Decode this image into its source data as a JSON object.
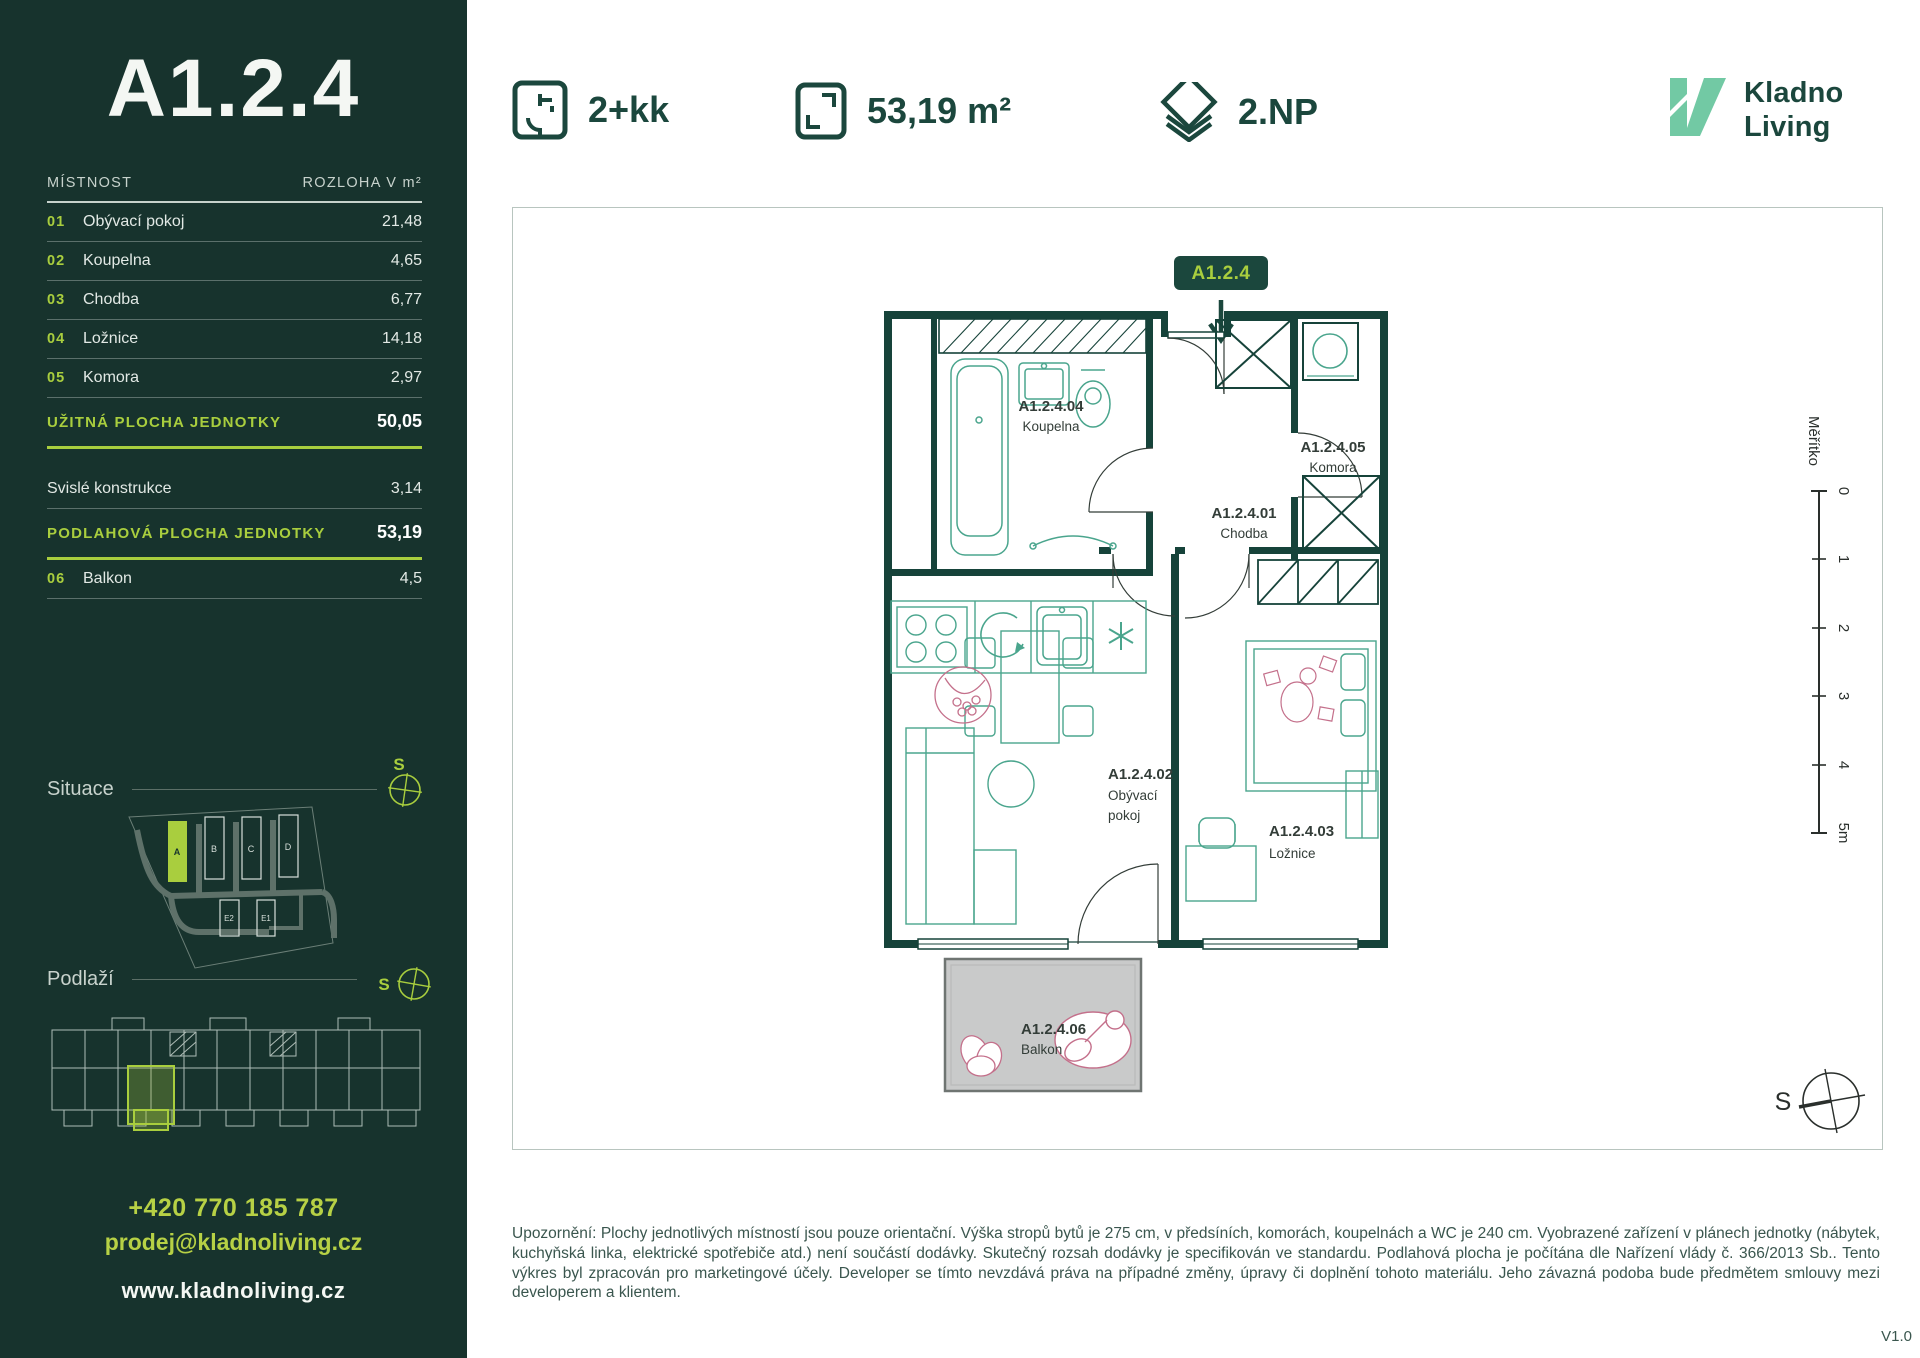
{
  "colors": {
    "sidebar_bg": "#17332D",
    "accent_lime": "#A9CE3E",
    "dark_teal": "#1B473D",
    "logo_mint": "#72C9A4",
    "furniture_teal": "#4AA58D",
    "decor_pink": "#C4708B",
    "balcony_gray": "#C9CACA"
  },
  "sidebar": {
    "unit_title": "A1.2.4",
    "table": {
      "col_room": "MÍSTNOST",
      "col_area": "ROZLOHA V m²",
      "rows": [
        {
          "num": "01",
          "name": "Obývací pokoj",
          "value": "21,48"
        },
        {
          "num": "02",
          "name": "Koupelna",
          "value": "4,65"
        },
        {
          "num": "03",
          "name": "Chodba",
          "value": "6,77"
        },
        {
          "num": "04",
          "name": "Ložnice",
          "value": "14,18"
        },
        {
          "num": "05",
          "name": "Komora",
          "value": "2,97"
        }
      ],
      "total_usable": {
        "label": "UŽITNÁ PLOCHA JEDNOTKY",
        "value": "50,05"
      },
      "vertical_row": {
        "name": "Svislé konstrukce",
        "value": "3,14"
      },
      "total_floor": {
        "label": "PODLAHOVÁ PLOCHA JEDNOTKY",
        "value": "53,19"
      },
      "balcony_row": {
        "num": "06",
        "name": "Balkon",
        "value": "4,5"
      }
    },
    "situace_label": "Situace",
    "podlazi_label": "Podlaží",
    "compass_letter_situace": "S",
    "compass_letter_podlazi": "S",
    "site_buildings": [
      "A",
      "B",
      "C",
      "D",
      "E2",
      "E1"
    ],
    "phone": "+420 770 185 787",
    "email": "prodej@kladnoliving.cz",
    "website": "www.kladnoliving.cz"
  },
  "header": {
    "layout": "2+kk",
    "area": "53,19 m²",
    "floor": "2.NP",
    "logo_line1": "Kladno",
    "logo_line2": "Living"
  },
  "plan": {
    "badge": "A1.2.4",
    "rooms": [
      {
        "code": "A1.2.4.01",
        "name": "Chodba"
      },
      {
        "code": "A1.2.4.02",
        "name": "Obývací pokoj",
        "name_l1": "Obývací",
        "name_l2": "pokoj"
      },
      {
        "code": "A1.2.4.03",
        "name": "Ložnice"
      },
      {
        "code": "A1.2.4.04",
        "name": "Koupelna"
      },
      {
        "code": "A1.2.4.05",
        "name": "Komora"
      },
      {
        "code": "A1.2.4.06",
        "name": "Balkon"
      }
    ],
    "scale": {
      "label": "Měřítko",
      "ticks": [
        "0",
        "1",
        "2",
        "3",
        "4",
        "5m"
      ]
    },
    "compass_letter": "S"
  },
  "footer": {
    "disclaimer": "Upozornění: Plochy jednotlivých místností jsou pouze orientační. Výška stropů bytů je 275 cm, v předsíních, komorách, koupelnách a WC je 240 cm. Vyobrazené zařízení v plánech jednotky (nábytek, kuchyňská linka, elektrické spotřebiče atd.) není součástí dodávky. Skutečný rozsah dodávky je specifikován ve standardu. Podlahová plocha je počítána dle Nařízení vlády č. 366/2013 Sb.. Tento výkres byl zpracován pro marketingové účely. Developer se tímto nevzdává práva na případné změny, úpravy či doplnění tohoto materiálu. Jeho závazná podoba bude předmětem smlouvy mezi developerem a klientem.",
    "version": "V1.0"
  }
}
